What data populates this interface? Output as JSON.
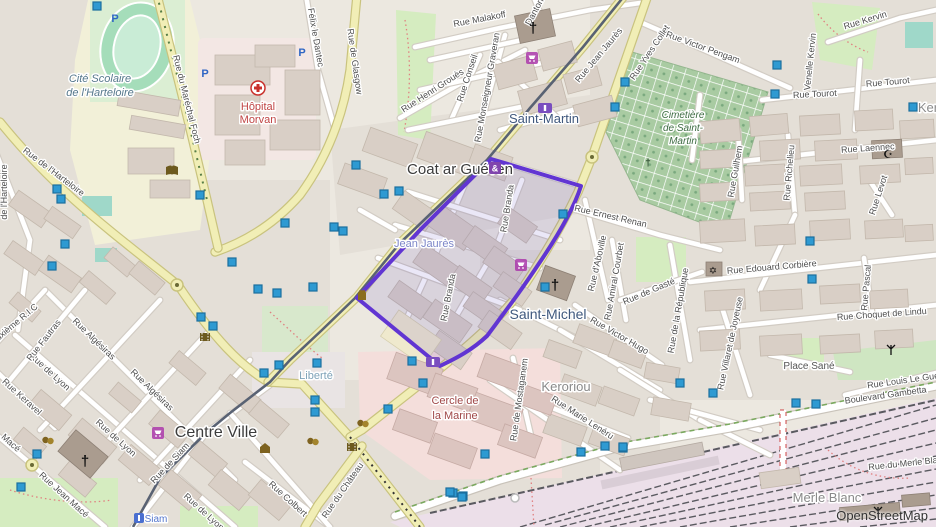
{
  "map": {
    "attribution": "OpenStreetMap",
    "colors": {
      "selection_stroke": "#6135d2",
      "selection_fill": "rgba(90,70,190,0.13)",
      "node_marker_fill": "#2e9ad2",
      "node_marker_stroke": "#1b6f9e",
      "major_road": "#f1eeb6",
      "tram": "#596273",
      "cemetery_green": "#a9cba2",
      "park_green": "#d5ecc0"
    },
    "places": [
      {
        "text": "Cité Scolaire",
        "x": 100,
        "y": 82,
        "cls": "school"
      },
      {
        "text": "de l'Harteloire",
        "x": 100,
        "y": 96,
        "cls": "school"
      },
      {
        "text": "Hôpital",
        "x": 258,
        "y": 110,
        "cls": "hospital"
      },
      {
        "text": "Morvan",
        "x": 258,
        "y": 123,
        "cls": "hospital"
      },
      {
        "text": "Coat ar Guéven",
        "x": 460,
        "y": 174,
        "cls": "quarter"
      },
      {
        "text": "Saint-Martin",
        "x": 544,
        "y": 123,
        "cls": "quarter-blue"
      },
      {
        "text": "Jean Jaurès",
        "x": 424,
        "y": 247,
        "cls": "neigh"
      },
      {
        "text": "Saint-Michel",
        "x": 548,
        "y": 319,
        "cls": "quarter-blue2"
      },
      {
        "text": "Centre Ville",
        "x": 216,
        "y": 437,
        "cls": "quarter-big"
      },
      {
        "text": "Liberté",
        "x": 316,
        "y": 379,
        "cls": "neigh-cyan"
      },
      {
        "text": "Keroriou",
        "x": 566,
        "y": 391,
        "cls": "place-gray"
      },
      {
        "text": "Ker",
        "x": 928,
        "y": 112,
        "cls": "place-gray"
      },
      {
        "text": "Merle Blanc",
        "x": 827,
        "y": 502,
        "cls": "place-gray"
      },
      {
        "text": "Siam",
        "x": 156,
        "y": 522,
        "cls": "tram-name"
      },
      {
        "text": "Cimetière",
        "x": 683,
        "y": 118,
        "cls": "cem"
      },
      {
        "text": "de Saint-",
        "x": 683,
        "y": 131,
        "cls": "cem"
      },
      {
        "text": "Martin",
        "x": 683,
        "y": 144,
        "cls": "cem"
      },
      {
        "text": "Cercle de",
        "x": 455,
        "y": 404,
        "cls": "marine"
      },
      {
        "text": "la Marine",
        "x": 455,
        "y": 419,
        "cls": "marine"
      },
      {
        "text": "Place Sané",
        "x": 809,
        "y": 369,
        "cls": "small-gray"
      }
    ],
    "streets": [
      {
        "text": "Rue du Maréchal Foch",
        "x": 184,
        "y": 100,
        "rot": 76
      },
      {
        "text": "Rue de l'Harteloire",
        "x": 52,
        "y": 174,
        "rot": 37
      },
      {
        "text": "de l'Harteloire",
        "x": 7,
        "y": 192,
        "rot": -90
      },
      {
        "text": "Félix le Dantec",
        "x": 313,
        "y": 38,
        "rot": 80
      },
      {
        "text": "Rue de Glasgow",
        "x": 352,
        "y": 62,
        "rot": 82
      },
      {
        "text": "Rue Malakoff",
        "x": 480,
        "y": 22,
        "rot": -11
      },
      {
        "text": "Danton",
        "x": 537,
        "y": 13,
        "rot": -62
      },
      {
        "text": "Rue Henri Grouès",
        "x": 434,
        "y": 93,
        "rot": -33
      },
      {
        "text": "Rue Conseil",
        "x": 470,
        "y": 79,
        "rot": -72
      },
      {
        "text": "Rue Monseigneur Graveran",
        "x": 490,
        "y": 88,
        "rot": -80
      },
      {
        "text": "Rue Jean Jaurès",
        "x": 601,
        "y": 57,
        "rot": -50
      },
      {
        "text": "Rue Yves Collet",
        "x": 652,
        "y": 54,
        "rot": -56
      },
      {
        "text": "Rue Victor Pengam",
        "x": 702,
        "y": 50,
        "rot": 20
      },
      {
        "text": "Rue Kervin",
        "x": 866,
        "y": 23,
        "rot": -17
      },
      {
        "text": "Venelle Kervin",
        "x": 813,
        "y": 62,
        "rot": -84
      },
      {
        "text": "Rue Tourot",
        "x": 815,
        "y": 97,
        "rot": -3
      },
      {
        "text": "Rue Tourot",
        "x": 888,
        "y": 85,
        "rot": -5
      },
      {
        "text": "Rue Laennec",
        "x": 868,
        "y": 151,
        "rot": -4
      },
      {
        "text": "Rue Richelieu",
        "x": 792,
        "y": 173,
        "rot": -85
      },
      {
        "text": "Rue Guilhem",
        "x": 738,
        "y": 172,
        "rot": -80
      },
      {
        "text": "Rue Ernest Renan",
        "x": 610,
        "y": 219,
        "rot": 13
      },
      {
        "text": "Rue d'Aboville",
        "x": 600,
        "y": 264,
        "rot": -77
      },
      {
        "text": "Rue Amiral Courbet",
        "x": 617,
        "y": 282,
        "rot": -80
      },
      {
        "text": "Rue Edouard Corbière",
        "x": 772,
        "y": 270,
        "rot": -5
      },
      {
        "text": "Rue de la République",
        "x": 681,
        "y": 311,
        "rot": -80
      },
      {
        "text": "Rue de Gasté",
        "x": 650,
        "y": 294,
        "rot": -23
      },
      {
        "text": "Rue Victor Hugo",
        "x": 618,
        "y": 338,
        "rot": 30
      },
      {
        "text": "Rue Choquet de Lindu",
        "x": 882,
        "y": 317,
        "rot": -4
      },
      {
        "text": "Rue Pascal",
        "x": 869,
        "y": 288,
        "rot": -85
      },
      {
        "text": "Rue Levot",
        "x": 881,
        "y": 196,
        "rot": -72
      },
      {
        "text": "Rue Villaret de Joyeuse",
        "x": 733,
        "y": 344,
        "rot": -78
      },
      {
        "text": "Boulevard Gambetta",
        "x": 886,
        "y": 398,
        "rot": -8
      },
      {
        "text": "Rue Louis Le Guen",
        "x": 906,
        "y": 383,
        "rot": -8
      },
      {
        "text": "Rue du Merle Blanc",
        "x": 908,
        "y": 466,
        "rot": -6
      },
      {
        "text": "Rue Marie Lenéru",
        "x": 581,
        "y": 420,
        "rot": 33
      },
      {
        "text": "Rue de Mostaganem",
        "x": 522,
        "y": 400,
        "rot": -82
      },
      {
        "text": "Rue Branda",
        "x": 510,
        "y": 209,
        "rot": -81
      },
      {
        "text": "Rue Branda",
        "x": 451,
        "y": 298,
        "rot": -79
      },
      {
        "text": "Rue du Château",
        "x": 345,
        "y": 492,
        "rot": -55
      },
      {
        "text": "Rue Colbert",
        "x": 286,
        "y": 501,
        "rot": 42
      },
      {
        "text": "Rue de Siam",
        "x": 172,
        "y": 465,
        "rot": -47
      },
      {
        "text": "Rue de Lyon",
        "x": 48,
        "y": 374,
        "rot": 42
      },
      {
        "text": "Rue de Lyon",
        "x": 114,
        "y": 440,
        "rot": 42
      },
      {
        "text": "Rue de Lyon",
        "x": 202,
        "y": 514,
        "rot": 42
      },
      {
        "text": "Rue Keravel",
        "x": 20,
        "y": 399,
        "rot": 42
      },
      {
        "text": "Macé",
        "x": 9,
        "y": 445,
        "rot": 42
      },
      {
        "text": "Rue Jean Macé",
        "x": 62,
        "y": 497,
        "rot": 42
      },
      {
        "text": "Rue Algésiras",
        "x": 92,
        "y": 341,
        "rot": 44
      },
      {
        "text": "Rue Algésiras",
        "x": 150,
        "y": 392,
        "rot": 44
      },
      {
        "text": "Rue Fautras",
        "x": 46,
        "y": 342,
        "rot": -52
      },
      {
        "text": "Deuxième R.I.C",
        "x": 14,
        "y": 328,
        "rot": -40
      }
    ],
    "markers": [
      [
        97,
        6
      ],
      [
        57,
        189
      ],
      [
        61,
        199
      ],
      [
        65,
        244
      ],
      [
        52,
        266
      ],
      [
        200,
        195
      ],
      [
        232,
        262
      ],
      [
        258,
        289
      ],
      [
        277,
        293
      ],
      [
        285,
        223
      ],
      [
        201,
        317
      ],
      [
        213,
        326
      ],
      [
        313,
        287
      ],
      [
        356,
        165
      ],
      [
        384,
        194
      ],
      [
        399,
        191
      ],
      [
        334,
        227
      ],
      [
        343,
        231
      ],
      [
        563,
        214
      ],
      [
        545,
        287
      ],
      [
        412,
        361
      ],
      [
        423,
        383
      ],
      [
        453,
        493
      ],
      [
        463,
        496
      ],
      [
        625,
        82
      ],
      [
        615,
        107
      ],
      [
        777,
        65
      ],
      [
        775,
        94
      ],
      [
        810,
        241
      ],
      [
        812,
        279
      ],
      [
        680,
        383
      ],
      [
        713,
        393
      ],
      [
        796,
        403
      ],
      [
        816,
        404
      ],
      [
        623,
        448
      ],
      [
        317,
        363
      ],
      [
        315,
        400
      ],
      [
        315,
        412
      ],
      [
        388,
        409
      ],
      [
        581,
        452
      ],
      [
        264,
        373
      ],
      [
        279,
        365
      ],
      [
        21,
        487
      ],
      [
        37,
        454
      ],
      [
        485,
        454
      ],
      [
        605,
        446
      ],
      [
        623,
        447
      ],
      [
        450,
        492
      ],
      [
        462,
        497
      ],
      [
        913,
        107
      ]
    ],
    "pois": [
      {
        "type": "parking-icon",
        "x": 115,
        "y": 18
      },
      {
        "type": "parking-icon",
        "x": 205,
        "y": 73
      },
      {
        "type": "parking-icon",
        "x": 302,
        "y": 52
      },
      {
        "type": "hospital-cross-icon",
        "x": 258,
        "y": 88
      },
      {
        "type": "church-icon",
        "x": 533,
        "y": 28
      },
      {
        "type": "church-icon",
        "x": 555,
        "y": 285
      },
      {
        "type": "church-icon",
        "x": 85,
        "y": 461
      },
      {
        "type": "cemetery-cross-icon",
        "x": 648,
        "y": 162
      },
      {
        "type": "mosque-icon",
        "x": 888,
        "y": 154
      },
      {
        "type": "synagogue-icon",
        "x": 713,
        "y": 270
      },
      {
        "type": "theatre-icon",
        "x": 363,
        "y": 423
      },
      {
        "type": "theatre-icon",
        "x": 313,
        "y": 441
      },
      {
        "type": "theatre-icon",
        "x": 48,
        "y": 440
      },
      {
        "type": "bank-icon",
        "x": 265,
        "y": 449
      },
      {
        "type": "cinema-icon",
        "x": 205,
        "y": 337
      },
      {
        "type": "cinema-icon",
        "x": 352,
        "y": 447
      },
      {
        "type": "library-icon",
        "x": 172,
        "y": 171
      },
      {
        "type": "monument-icon",
        "x": 362,
        "y": 296
      },
      {
        "type": "supermarket-icon",
        "x": 532,
        "y": 58
      },
      {
        "type": "supermarket-icon",
        "x": 158,
        "y": 433
      },
      {
        "type": "supermarket-icon",
        "x": 521,
        "y": 265
      },
      {
        "type": "amp-badge-icon",
        "x": 495,
        "y": 168
      },
      {
        "type": "tram-stop-icon",
        "x": 545,
        "y": 108
      },
      {
        "type": "tram-stop-icon",
        "x": 433,
        "y": 362
      },
      {
        "type": "tram-stop-blue-icon",
        "x": 139,
        "y": 518
      },
      {
        "type": "antenna-icon",
        "x": 891,
        "y": 350
      },
      {
        "type": "antenna-icon",
        "x": 878,
        "y": 512
      }
    ]
  }
}
